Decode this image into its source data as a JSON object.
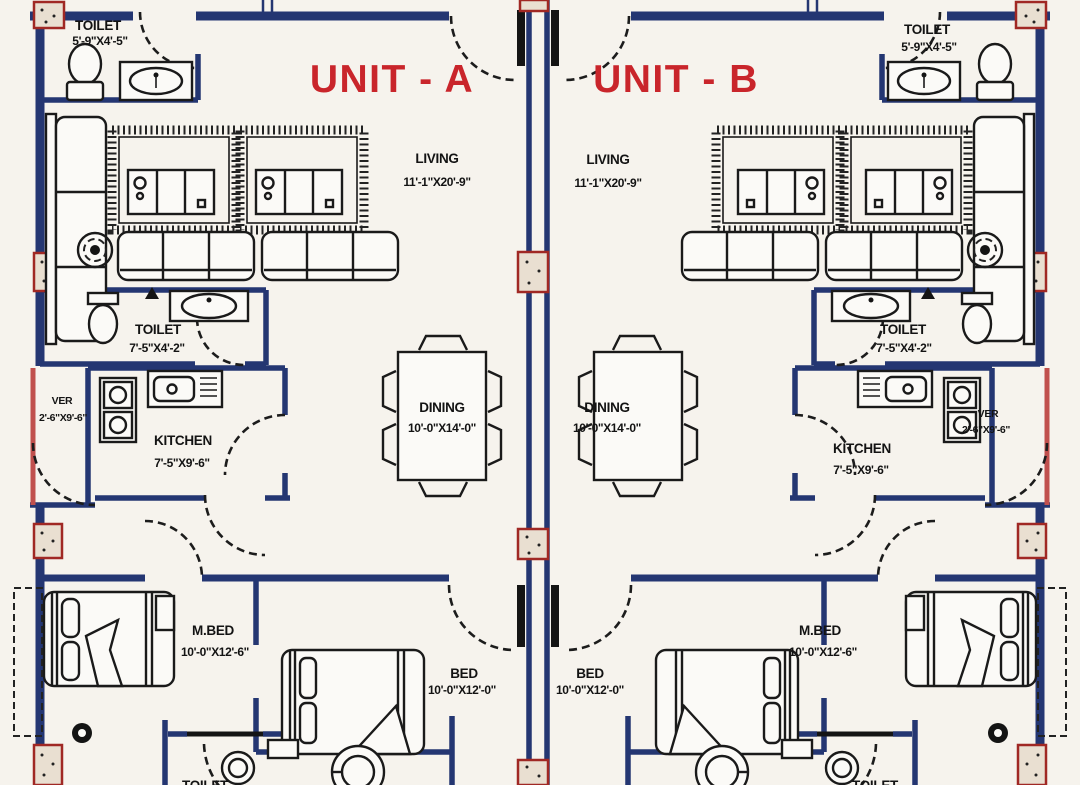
{
  "plan": {
    "unit_a": {
      "title": "UNIT - A",
      "toilet_top": {
        "name": "TOILET",
        "size": "5'-9\"X4'-5\""
      },
      "living": {
        "name": "LIVING",
        "size": "11'-1\"X20'-9\""
      },
      "toilet_mid": {
        "name": "TOILET",
        "size": "7'-5\"X4'-2\""
      },
      "ver": {
        "name": "VER",
        "size": "2'-6\"X9'-6\""
      },
      "kitchen": {
        "name": "KITCHEN",
        "size": "7'-5\"X9'-6\""
      },
      "dining": {
        "name": "DINING",
        "size": "10'-0\"X14'-0\""
      },
      "master_bed": {
        "name": "M.BED",
        "size": "10'-0\"X12'-6\""
      },
      "bed": {
        "name": "BED",
        "size": "10'-0\"X12'-0\""
      },
      "toilet_bottom": {
        "name": "TOILET"
      }
    },
    "unit_b": {
      "title": "UNIT - B",
      "toilet_top": {
        "name": "TOILET",
        "size": "5'-9\"X4'-5\""
      },
      "living": {
        "name": "LIVING",
        "size": "11'-1\"X20'-9\""
      },
      "toilet_mid": {
        "name": "TOILET",
        "size": "7'-5\"X4'-2\""
      },
      "ver": {
        "name": "VER",
        "size": "2'-6\"X9'-6\""
      },
      "kitchen": {
        "name": "KITCHEN",
        "size": "7'-5\"X9'-6\""
      },
      "dining": {
        "name": "DINING",
        "size": "10'-0\"X14'-0\""
      },
      "master_bed": {
        "name": "M.BED",
        "size": "10'-0\"X12'-6\""
      },
      "bed": {
        "name": "BED",
        "size": "10'-0\"X12'-0\""
      },
      "toilet_bottom": {
        "name": "TOILET"
      }
    },
    "colors": {
      "wall_blue": "#243672",
      "title_red": "#c9252b",
      "column_red": "#a02824",
      "veranda_pink": "#c0504d"
    }
  }
}
